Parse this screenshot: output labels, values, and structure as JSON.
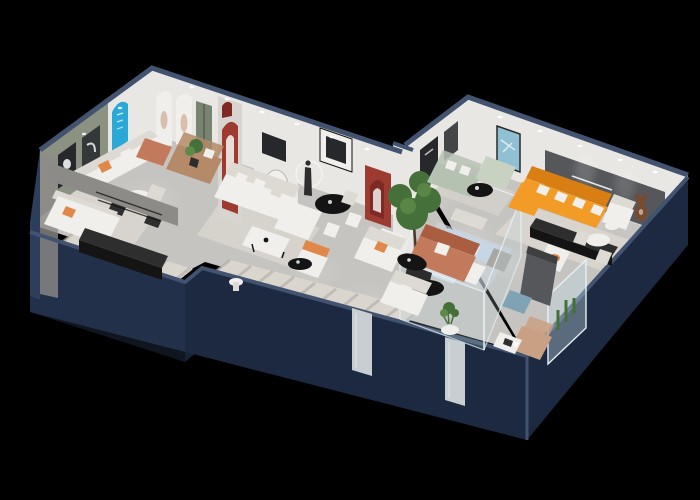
{
  "scene": {
    "title": "3D isometric cutaway floor-plan render of a furniture showroom",
    "background": "#000000",
    "wall_slogan": {
      "lines": 2,
      "legible": false
    },
    "palette": {
      "wall_navy": "#1c2940",
      "wall_navy_light": "#2d3e5c",
      "wall_navy_top": "#41536f",
      "wall_white": "#e9e7e3",
      "wall_white_dim": "#d8d5d0",
      "wall_green": "#8c9282",
      "wall_gray": "#8d8b88",
      "panel_dark": "#55575a",
      "floor_light": "#c6c4c0",
      "floor_dim": "#a9a7a3",
      "rug_light": "#dad6ce",
      "rug_stripe": "#b3afa7",
      "rug_blue": "#ccd6de",
      "sofa_white": "#f1efeb",
      "sofa_white_shade": "#ddd9d3",
      "sofa_orange": "#f29b26",
      "sofa_orange_shade": "#d87e12",
      "sofa_sage": "#b6c2b1",
      "sofa_mint": "#c7d2c3",
      "sofa_terracotta": "#c37a5c",
      "sofa_terracotta_shade": "#aa5d41",
      "sofa_blue": "#c7d6e4",
      "sofa_blue_light": "#d9e3ec",
      "sofa_tan": "#c9a083",
      "sofa_brown": "#b48a68",
      "pillow_orange": "#e0884a",
      "furn_black": "#141414",
      "furn_black_top": "#2e2e2e",
      "accent_blue": "#2aa9d6",
      "accent_red": "#9e3b31",
      "accent_red_dark": "#7c2a23",
      "door_green": "#798372",
      "art_teal": "#8fc0d4",
      "art_dark": "#26282b",
      "glass_tint": "#bcd7e1",
      "glass_edge": "#e6f1f5",
      "mirror": "#c9ced2",
      "plant_green": "#46703a",
      "plant_green_light": "#5d8a48",
      "pot_dark": "#2c2c2c",
      "bear_brown": "#7a4a2e",
      "ottoman_blue": "#7fa3b5",
      "glow_white": "#ffffff"
    },
    "rooms": [
      {
        "id": "green-lounge",
        "label": "sage-green lounge vignette with arched gallery wall"
      },
      {
        "id": "lower-left-room",
        "label": "media console room"
      },
      {
        "id": "white-sectional-room",
        "label": "white sectional lounge with dining set"
      },
      {
        "id": "glass-sage-room",
        "label": "sage sofa room behind glass"
      },
      {
        "id": "glass-display-box",
        "label": "glass display box with pale blue sofa set"
      },
      {
        "id": "orange-lounge",
        "label": "orange sectional lounge with dark slogan wall"
      },
      {
        "id": "terracotta-lounge",
        "label": "terracotta sofa vignette"
      },
      {
        "id": "corner-accessories",
        "label": "corner zone with wardrobe, glass vitrine and lounge chair"
      }
    ]
  }
}
